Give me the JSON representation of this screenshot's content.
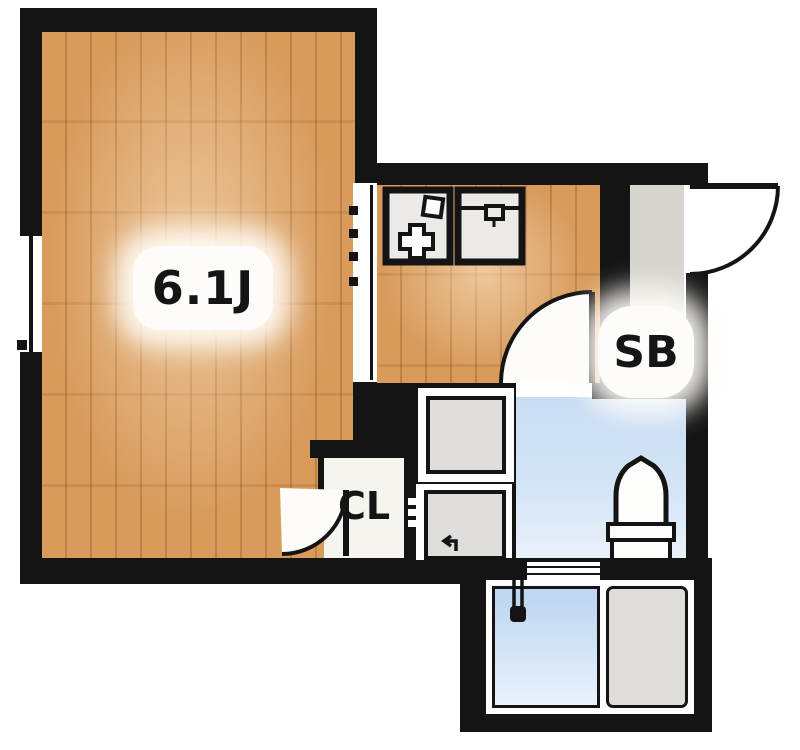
{
  "labels": {
    "main_room_size": "6.1J",
    "shoe_box": "SB",
    "closet": "CL"
  },
  "colors": {
    "wall": "#141414",
    "wood": "#D89B5C",
    "washroom_floor": "#C8DCF4",
    "bathtub": "#BFD7F1",
    "bathtub_light": "#EAF2FB",
    "entry_floor": "#D8D5CF",
    "bath_panel": "#DFDDD9",
    "appliance_gray": "#E0DEDA",
    "closet_floor": "#F6F4EF",
    "counter": "#ECEAE6"
  }
}
